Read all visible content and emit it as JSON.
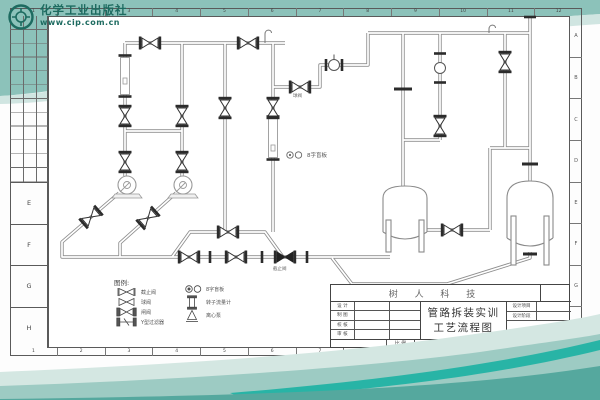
{
  "logo": {
    "name": "化学工业出版社",
    "url": "www.cip.com.cn"
  },
  "zones": {
    "top": [
      "1",
      "2",
      "3",
      "4",
      "5",
      "6",
      "7",
      "8",
      "9",
      "10",
      "11",
      "12"
    ],
    "bottom": [
      "1",
      "2",
      "3",
      "4",
      "5",
      "6",
      "7",
      "8",
      "9",
      "10",
      "11",
      "12"
    ],
    "right": [
      "A",
      "B",
      "C",
      "D",
      "E",
      "F",
      "G",
      "H"
    ],
    "left": [
      "E",
      "F",
      "G",
      "H"
    ]
  },
  "drawing": {
    "annotations": {
      "ball_valve": "球阀",
      "blind": "8字盲板",
      "stop_valve": "截止阀"
    },
    "legend": {
      "title": "图例:",
      "left": [
        {
          "label": "截止阀"
        },
        {
          "label": "球阀"
        },
        {
          "label": "闸阀"
        },
        {
          "label": "Y型过滤器"
        }
      ],
      "right": [
        {
          "label": "8字盲板"
        },
        {
          "label": "转子流量计"
        },
        {
          "label": "离心泵"
        }
      ]
    }
  },
  "title_block": {
    "company": "树 人 科 技",
    "title_line1": "管路拆装实训",
    "title_line2": "工艺流程图",
    "left_rows": [
      "设 计",
      "制 图",
      "校 核",
      "审 核"
    ],
    "right_rows": [
      "设计项目",
      "设计阶段"
    ],
    "bottom": {
      "scale": "比 例",
      "specialty": "专 业",
      "sheet_no": "第",
      "total": "共",
      "page": "页",
      "sheet": "张"
    }
  },
  "colors": {
    "teal": "#8cc2ba",
    "teal_light": "#c3dcd6",
    "wave_deep": "#55a89e",
    "wave_accent": "#14b0a1",
    "logo_green": "#1d6b60",
    "line": "#555555"
  }
}
